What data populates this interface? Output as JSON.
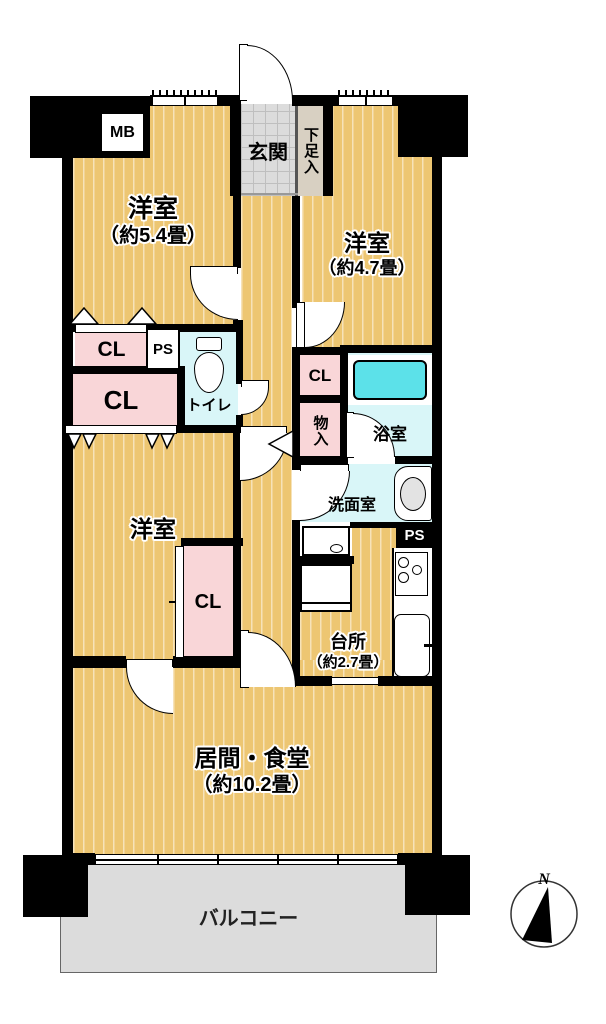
{
  "labels": {
    "mb": "MB",
    "entrance": "玄関",
    "shoe_storage": "下足入",
    "bedroom_nw": {
      "name": "洋室",
      "size": "（約5.4畳）"
    },
    "bedroom_ne": {
      "name": "洋室",
      "size": "（約4.7畳）"
    },
    "closet_nw_upper": "CL",
    "pipe_space_upper": "PS",
    "toilet": "トイレ",
    "closet_nw_lower": "CL",
    "closet_ne": "CL",
    "storage": "物入",
    "bathroom": "浴室",
    "washroom": "洗面室",
    "pipe_space_lower": "PS",
    "kitchen": {
      "name": "台所",
      "size": "（約2.7畳）"
    },
    "bedroom_w": "洋室",
    "closet_w": "CL",
    "living_dining": {
      "name": "居間・食堂",
      "size": "（約10.2畳）"
    },
    "balcony": "バルコニー",
    "compass_north": "N"
  },
  "colors": {
    "floor_wood": "#edc672",
    "closet_pink": "#f9d6d8",
    "wet_area_cyan": "#d9f6f8",
    "bathtub_cyan": "#5ce1e9",
    "entrance_gray": "#dcdcdc",
    "shoe_beige": "#d8d0c2",
    "balcony_gray": "#dcdcdc",
    "wall_black": "#000000"
  }
}
